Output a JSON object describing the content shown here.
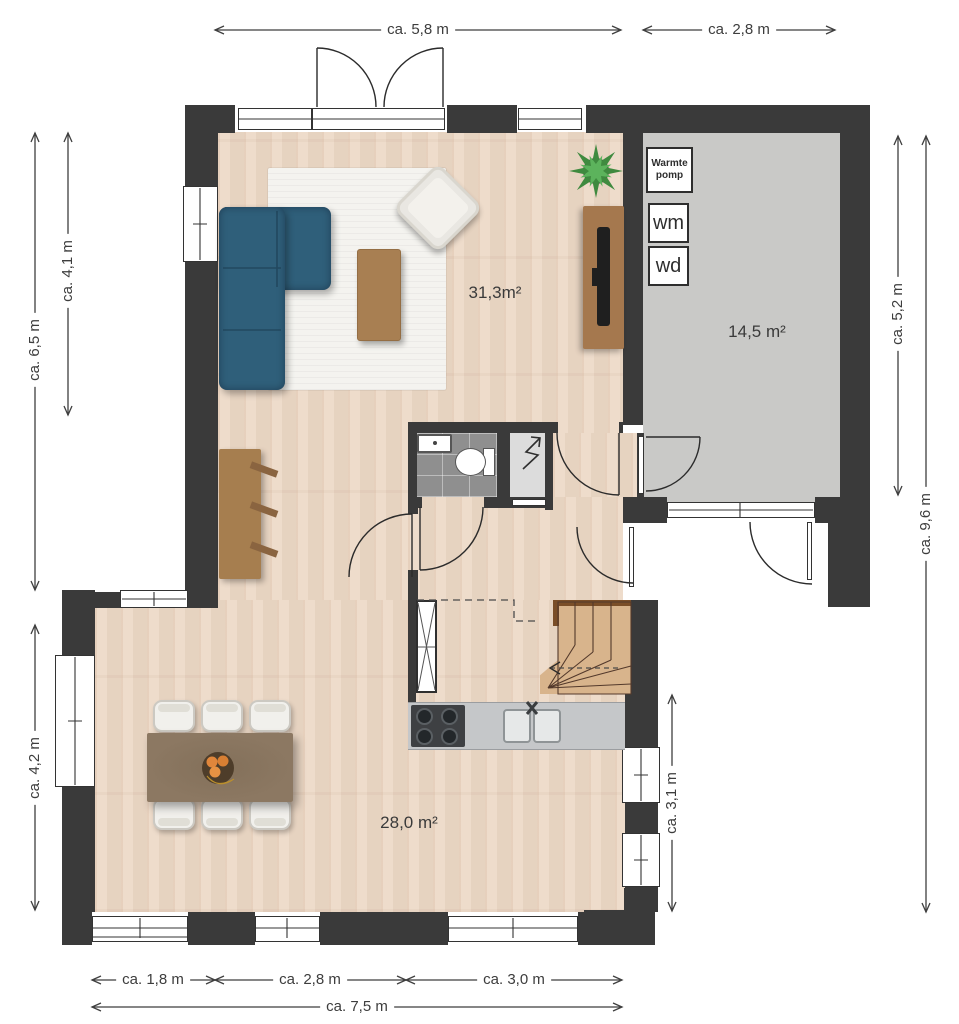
{
  "palette": {
    "wall": "#3a3a3a",
    "wood_floor": "#ecd8c5",
    "garage_floor": "#c9c9c7",
    "toilet_tiles": "#8f8f8f",
    "sofa": "#2f5f7a",
    "rug": "#f4f3ef",
    "wood_furniture": "#a5784e",
    "dining_table": "#8c7862",
    "stair_tread": "#d8b48c",
    "counter": "#c5c7c9",
    "dimension_text": "#3d3d3d"
  },
  "dimensions": {
    "top_living": "ca. 5,8 m",
    "top_garage": "ca. 2,8 m",
    "left_outer": "ca. 6,5 m",
    "left_inner": "ca. 4,1 m",
    "left_lower": "ca. 4,2 m",
    "right_garage": "ca. 5,2 m",
    "right_outer": "ca. 9,6 m",
    "right_kitchen": "ca. 3,1 m",
    "bottom_left": "ca. 1,8 m",
    "bottom_mid": "ca. 2,8 m",
    "bottom_right": "ca. 3,0 m",
    "bottom_total": "ca. 7,5 m"
  },
  "rooms": {
    "living_area": "31,3m²",
    "garage_area": "14,5 m²",
    "kitchen_area": "28,0 m²"
  },
  "utility": {
    "heat_pump": "Warmte pomp",
    "washer": "wm",
    "dryer": "wd"
  },
  "icons": {
    "plant": "potted-plant-icon",
    "meter_cupboard": "zigzag-meter-icon",
    "stair_direction": "stair-direction-arrow-icon",
    "dimension_arrows": "double-arrow-icon"
  }
}
